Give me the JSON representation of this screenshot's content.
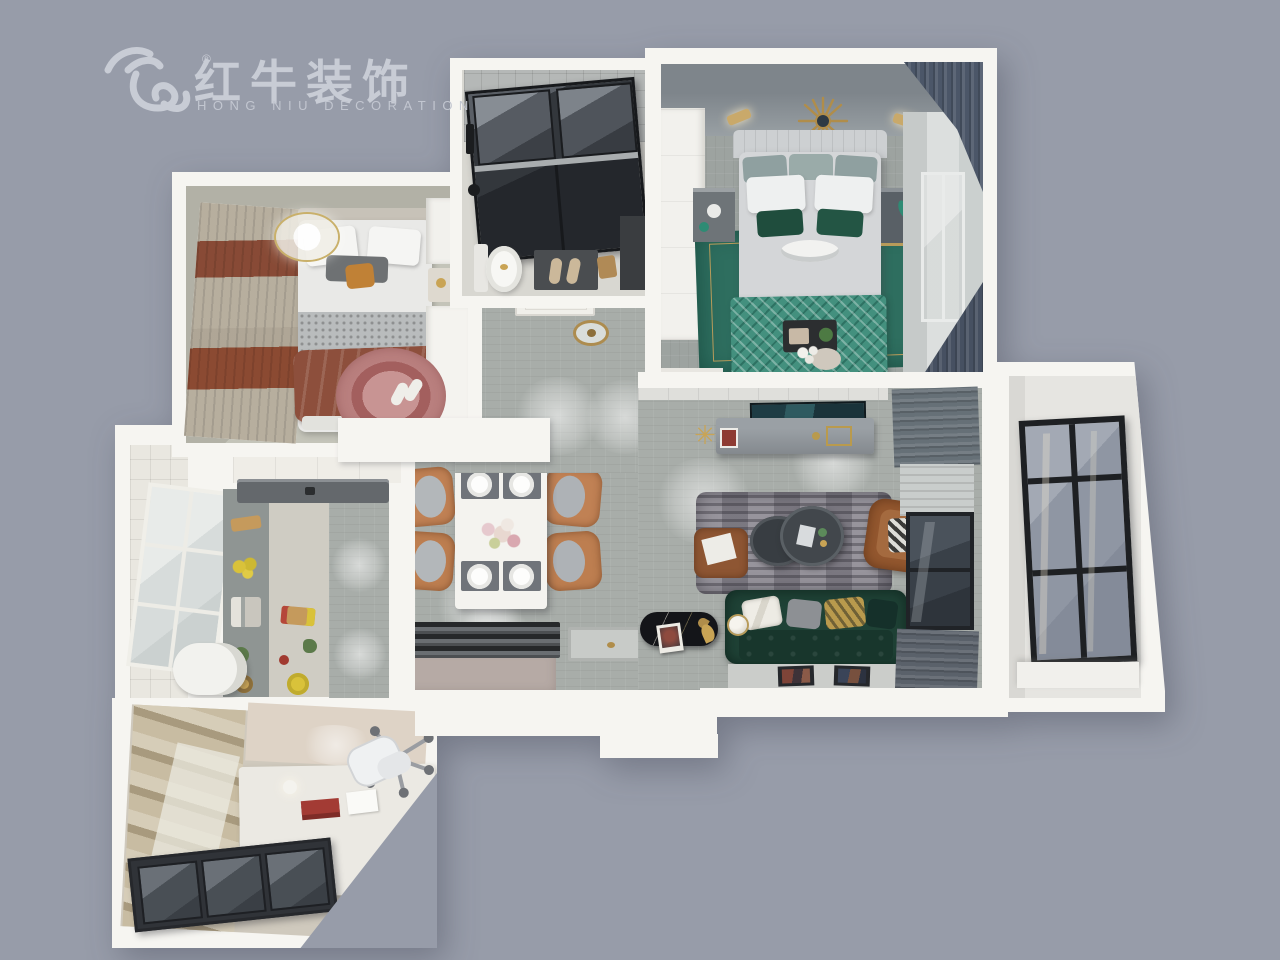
{
  "background_color": "#979CA9",
  "watermark_logo": {
    "icon": "bull-swoosh-icon",
    "registered_mark": "®",
    "brand_cn": "红牛装饰",
    "brand_en": "HONG NIU DECORATION",
    "text_color": "#C8CCD5"
  },
  "scene": {
    "type": "3d-top-down-apartment-floor-plan-render",
    "rooms": [
      {
        "name": "secondary-bedroom",
        "position": "top-left",
        "furniture": [
          "striped-curtains",
          "double-bed",
          "pillows",
          "rust-throw-blanket",
          "round-pink-rug",
          "slippers",
          "round-ceiling-light",
          "wardrobe"
        ],
        "accent_colors": {
          "curtain_stripe": "#A05A44",
          "blanket": "#8D4F3C",
          "rug": "#A35F5E"
        }
      },
      {
        "name": "bathroom",
        "position": "top-center",
        "furniture": [
          "glass-shower-enclosure",
          "shower-fixture",
          "toilet",
          "bath-mat",
          "slippers",
          "tiled-wall"
        ],
        "accent_colors": {
          "shower_glass": "#2C3036",
          "tile_wall": "#B5B8B7"
        }
      },
      {
        "name": "master-bedroom",
        "position": "top-right",
        "furniture": [
          "double-bed",
          "channel-headboard",
          "teal-patterned-throw",
          "green-pillows",
          "breakfast-tray",
          "teal-rug-gold-border",
          "nightstand-left",
          "nightstand-right",
          "sunburst-ceiling-ornament",
          "wall-sconces",
          "window-sheers",
          "navy-drapes",
          "wardrobe",
          "flower-side-table"
        ],
        "accent_colors": {
          "rug": "#2E6E5F",
          "throw": "#43907E",
          "drapes": "#4B5668",
          "ornament_gold": "#B08D4A"
        }
      },
      {
        "name": "entry-hallway",
        "position": "center",
        "furniture": [
          "bathroom-door",
          "bedroom-door",
          "gold-floor-ornament",
          "downlight-pools"
        ],
        "accent_colors": {
          "floor": "#A6ABA8"
        }
      },
      {
        "name": "kitchen",
        "position": "middle-left",
        "furniture": [
          "tiled-wall",
          "window",
          "counter-with-food",
          "open-shelving",
          "range-hood",
          "upper-cabinets",
          "water-heater"
        ],
        "accent_colors": {
          "tiles": "#E9E7E0",
          "hood": "#64686C"
        }
      },
      {
        "name": "dining-area",
        "position": "center",
        "furniture": [
          "dining-table",
          "four-place-settings",
          "flower-centerpiece",
          "four-cognac-chairs",
          "shoe-cabinet",
          "entry-doormat"
        ],
        "accent_colors": {
          "chairs": "#C08154",
          "cabinet_top": "#595C5F"
        }
      },
      {
        "name": "living-room",
        "position": "right",
        "furniture": [
          "tv",
          "media-console",
          "gold-decor",
          "area-rug",
          "round-coffee-table-large",
          "round-coffee-table-small",
          "cognac-armchair",
          "check-pillow",
          "ottoman",
          "green-velvet-sofa",
          "decor-pillows",
          "black-marble-side-table",
          "leaning-art-cards",
          "wall-art",
          "gray-curtains",
          "window"
        ],
        "accent_colors": {
          "sofa": "#1F4236",
          "armchair": "#94582F",
          "rug": "#8F8C95",
          "marble": "#141519"
        }
      },
      {
        "name": "balcony",
        "position": "far-right",
        "furniture": [
          "black-framed-window-wall",
          "window-sill"
        ],
        "accent_colors": {
          "window_frame": "#1E2023",
          "glass": "#959CAA"
        }
      },
      {
        "name": "study",
        "position": "bottom-left",
        "furniture": [
          "striped-curtains",
          "desk",
          "red-books",
          "white-office-chair",
          "glass-front-bookcase",
          "desk-lamp"
        ],
        "accent_colors": {
          "curtains": "#C3B69C",
          "books": "#A33B34"
        }
      }
    ]
  },
  "palette": {
    "wall_white": "#F6F5F1",
    "floor_wood_gray": "#A7ACA9",
    "ceiling_gray": "#8B9297",
    "shadow": "rgba(40,44,58,0.30)"
  }
}
